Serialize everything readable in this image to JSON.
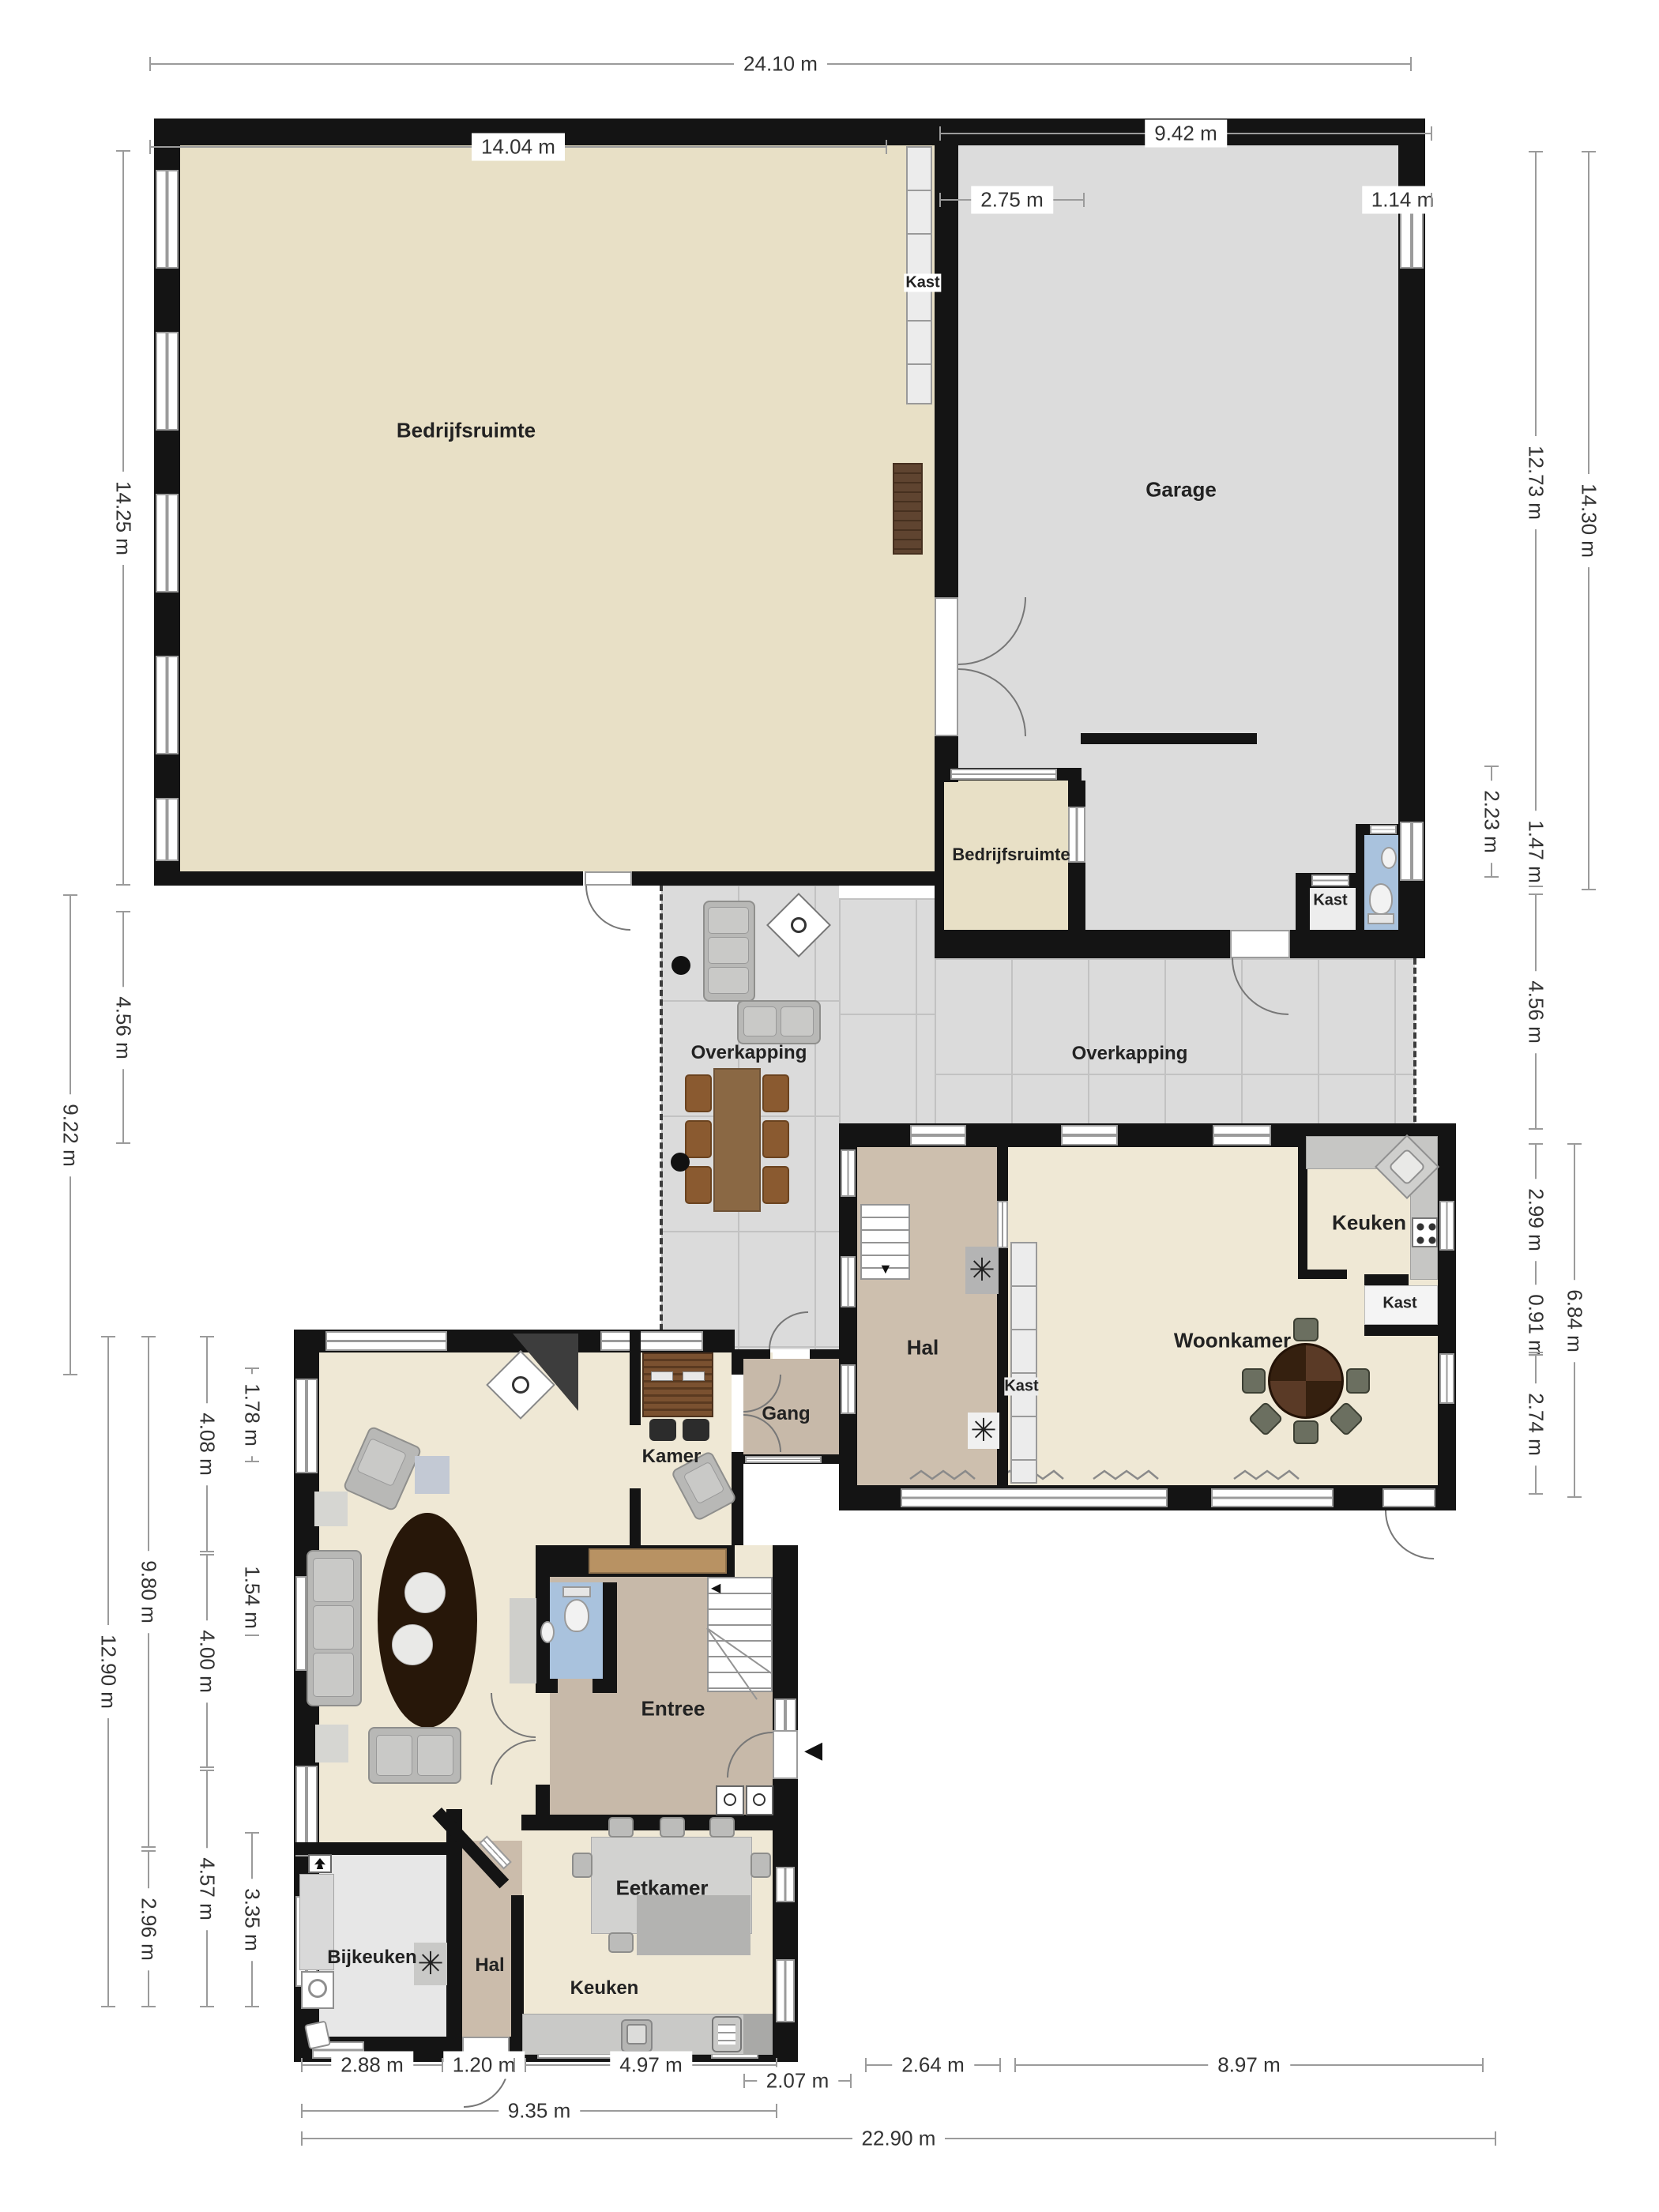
{
  "rooms": {
    "bedrijfsruimte_main": "Bedrijfsruimte",
    "garage": "Garage",
    "kast_strip": "Kast",
    "bedrijfsruimte_small": "Bedrijfsruimte",
    "kast_garage": "Kast",
    "overkapping_left": "Overkapping",
    "overkapping_right": "Overkapping",
    "keuken_boven": "Keuken",
    "kast_keuken": "Kast",
    "woonkamer": "Woonkamer",
    "hal_boven": "Hal",
    "kast_hal": "Kast",
    "gang": "Gang",
    "kamer": "Kamer",
    "entree": "Entree",
    "bijkeuken": "Bijkeuken",
    "hal_beneden": "Hal",
    "keuken_beneden": "Keuken",
    "eetkamer": "Eetkamer"
  },
  "dims": {
    "d2410": "24.10 m",
    "d1404": "14.04 m",
    "d942": "9.42 m",
    "d275": "2.75 m",
    "d114": "1.14 m",
    "d1425": "14.25 m",
    "d456l": "4.56 m",
    "d922": "9.22 m",
    "d1290": "12.90 m",
    "d980": "9.80 m",
    "d296": "2.96 m",
    "d408": "4.08 m",
    "d400": "4.00 m",
    "d457": "4.57 m",
    "d178": "1.78 m",
    "d154": "1.54 m",
    "d335": "3.35 m",
    "d1273": "12.73 m",
    "d1430": "14.30 m",
    "d223": "2.23 m",
    "d147": "1.47 m",
    "d456r": "4.56 m",
    "d299": "2.99 m",
    "d091": "0.91 m",
    "d274": "2.74 m",
    "d684": "6.84 m",
    "d288": "2.88 m",
    "d120": "1.20 m",
    "d497": "4.97 m",
    "d207": "2.07 m",
    "d264": "2.64 m",
    "d897": "8.97 m",
    "d935": "9.35 m",
    "d2290": "22.90 m"
  },
  "icons": {
    "asterisk": "✳",
    "arrow_down": "▼",
    "arrow_left": "◀"
  },
  "colors": {
    "wall": "#141414",
    "floor_cream": "#e8e0c6",
    "floor_cream_light": "#efe8d5",
    "floor_taupe": "#cdbfae",
    "floor_gray": "#dbdbdb",
    "floor_blue": "#a9c2dd",
    "dim_line": "#9b9b9b"
  }
}
